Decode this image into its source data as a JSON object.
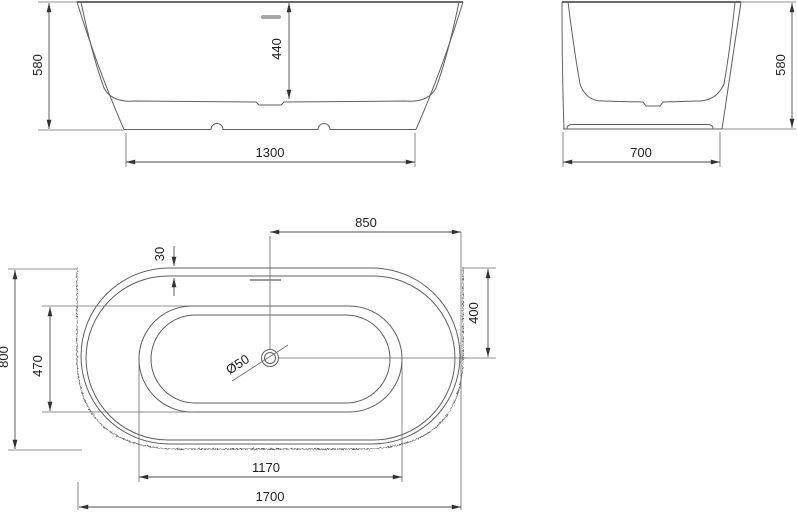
{
  "drawing": {
    "type": "bathtub-technical-drawing",
    "unit": "mm"
  },
  "front_view": {
    "height": "580",
    "inner_depth": "440",
    "base_width": "1300"
  },
  "side_view": {
    "height": "580",
    "base_width": "700"
  },
  "top_view": {
    "overall_length": "1700",
    "overall_width": "800",
    "drain_to_end": "850",
    "drain_to_side": "400",
    "rim_offset": "30",
    "basin_width": "470",
    "basin_bottom_length": "1170",
    "drain_diameter": "Ø50"
  },
  "colors": {
    "background": "#ffffff",
    "line": "#5f5f5f",
    "dimension_line": "#4c4c4c",
    "text": "#1f1f1f",
    "overflow_fill": "#a6a6a6"
  }
}
